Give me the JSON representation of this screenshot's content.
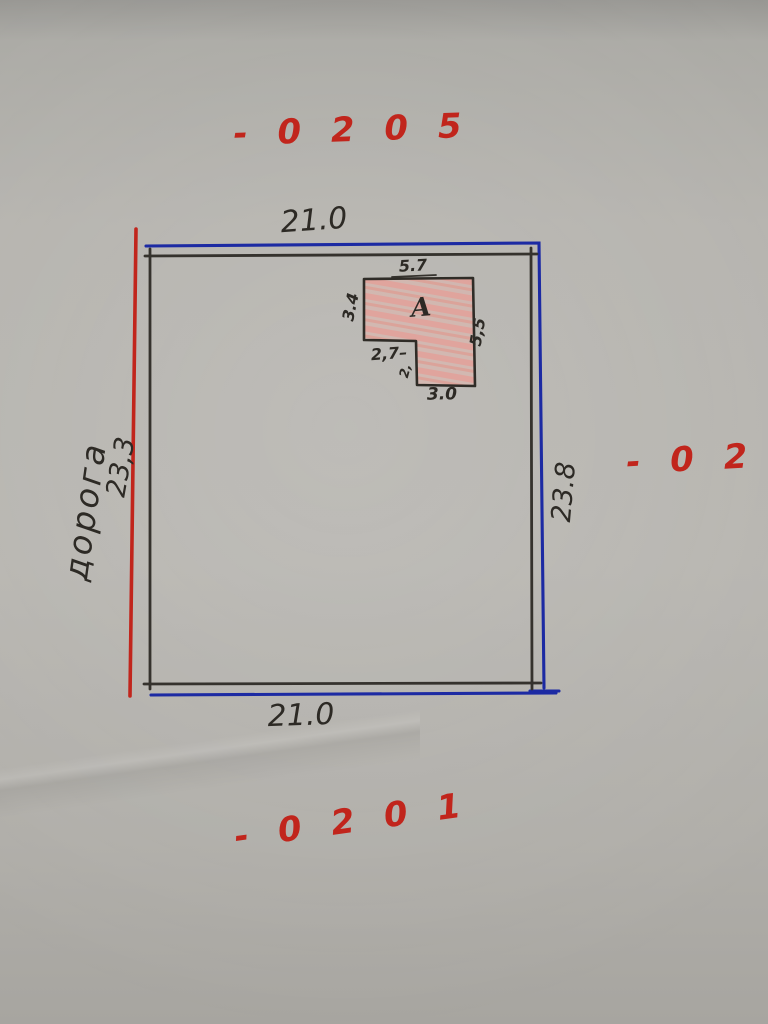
{
  "codes": {
    "top": "- 0 2 0 5",
    "right": "- 0 2 0",
    "bottom": "- 0 2 0 1"
  },
  "plot": {
    "top_width": "21.0",
    "bottom_width": "21.0",
    "left_depth": "23,3",
    "right_depth": "23.8",
    "road": "дорога"
  },
  "building": {
    "label": "A",
    "top_width": "5.7",
    "left_height": "3.4",
    "right_height": "5,5",
    "notch_width": "2,7–",
    "notch_height": "2,",
    "bottom_width": "3.0"
  },
  "colors": {
    "paper": "#b5b3ae",
    "ink_black": "#312e29",
    "ink_blue": "#1c2aa3",
    "ink_red": "#c1251c",
    "building_fill": "#eda49c"
  }
}
